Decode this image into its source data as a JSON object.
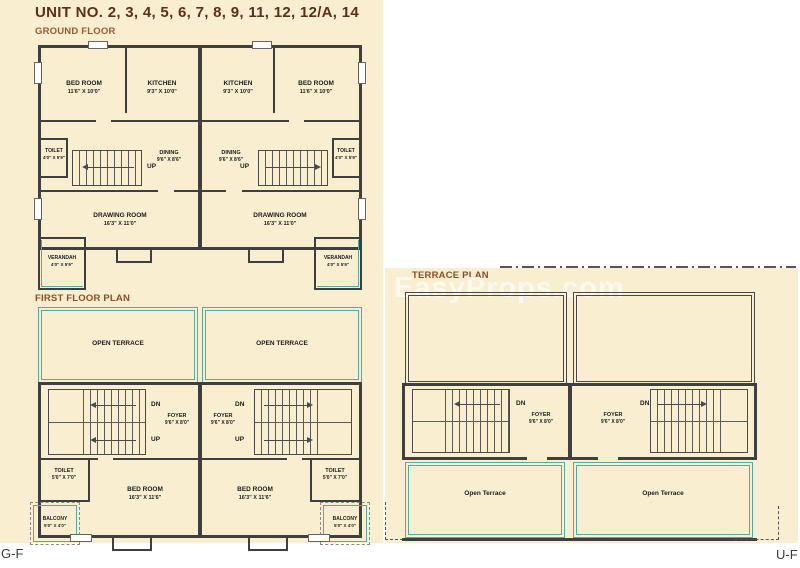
{
  "header": {
    "title": "UNIT NO. 2, 3, 4, 5, 6, 7, 8, 9, 11, 12, 12/A, 14"
  },
  "sections": {
    "ground": "GROUND FLOOR",
    "first": "FIRST FLOOR PLAN",
    "terrace": "TERRACE PLAN"
  },
  "watermark": "EasyProps.com",
  "corners": {
    "left": "G-F",
    "right": "U-F"
  },
  "colors": {
    "background": "#FFFFFF",
    "paper": "#F9EECF",
    "wall": "#3F3F3F",
    "teal": "#4FADA6",
    "title_brown": "#5A3018",
    "section_label_brown": "#8A4F26"
  },
  "ground": {
    "bedroom": {
      "name": "BED ROOM",
      "dim": "11'6\" X 10'0\""
    },
    "kitchen": {
      "name": "KITCHEN",
      "dim": "9'3\" X 10'0\""
    },
    "dining": {
      "name": "DINING",
      "dim": "9'6\" X 8'6\""
    },
    "drawing": {
      "name": "DRAWING ROOM",
      "dim": "16'3\" X 11'0\""
    },
    "toilet": {
      "name": "TOILET",
      "dim": "4'0\" X 5'9\""
    },
    "verandah": {
      "name": "VERANDAH",
      "dim": "4'0\" X 5'9\""
    },
    "up": "UP"
  },
  "first": {
    "open_terrace": "OPEN TERRACE",
    "foyer": {
      "name": "FOYER",
      "dim": "9'6\" X 8'0\""
    },
    "toilet": {
      "name": "TOILET",
      "dim": "5'0\" X 7'0\""
    },
    "bedroom": {
      "name": "BED ROOM",
      "dim": "16'3\" X 11'6\""
    },
    "balcony": {
      "name": "BALCONY",
      "dim": "5'0\" X 4'0\""
    },
    "dn": "DN",
    "up": "UP"
  },
  "terrace": {
    "foyer": {
      "name": "FOYER",
      "dim": "9'6\" X 8'0\""
    },
    "open_terrace": "Open Terrace",
    "dn": "DN"
  }
}
